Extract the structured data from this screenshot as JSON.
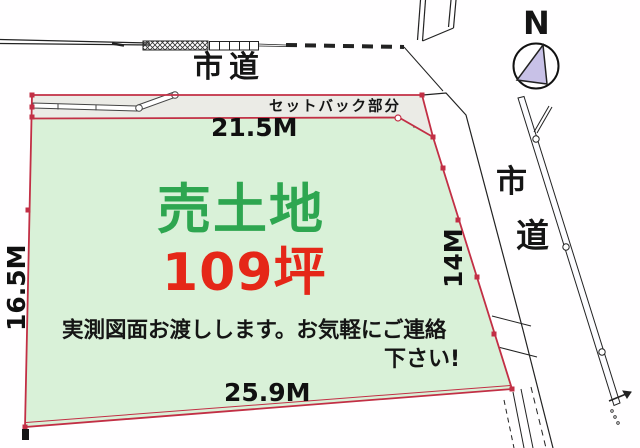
{
  "compass": {
    "label": "N"
  },
  "roads": {
    "top_label": "市道",
    "right_char_1": "市",
    "right_char_2": "道"
  },
  "parcel": {
    "title": "売土地",
    "area": "109坪",
    "setback_label": "セットバック部分",
    "note_line_1": "実測図面お渡しします。お気軽にご連絡",
    "note_line_2": "下さい!",
    "dimensions": {
      "top": "21.5M",
      "left": "16.5M",
      "right": "14M",
      "bottom": "25.9M"
    }
  },
  "colors": {
    "land_fill": "#d9f1d8",
    "setback_fill": "#ebebe6",
    "boundary_red": "#c22f45",
    "title_green": "#2ea650",
    "area_red": "#e52718",
    "compass_triangle": "#c8c1e7",
    "line_black": "#222222"
  }
}
